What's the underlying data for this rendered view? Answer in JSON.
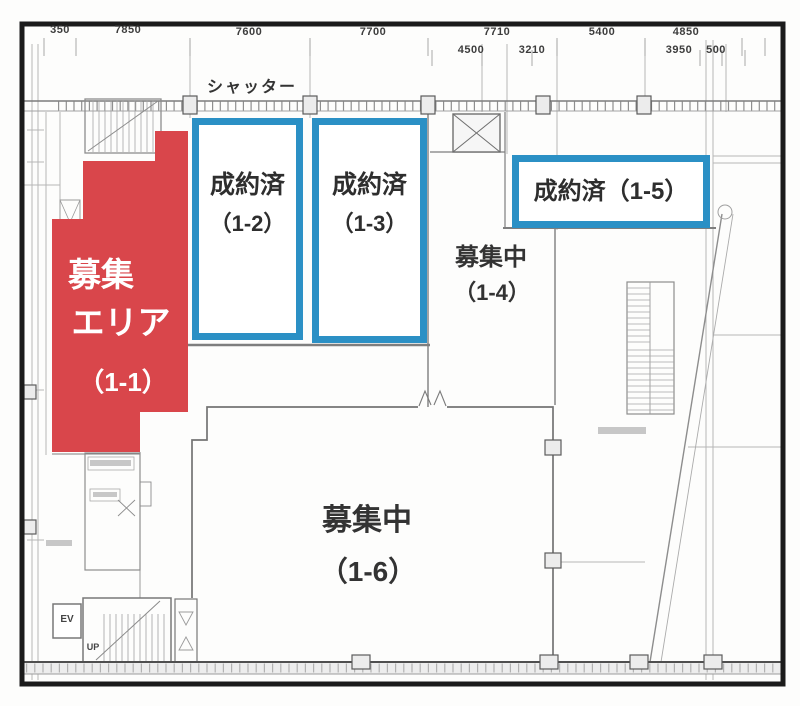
{
  "colors": {
    "red": "#d9464b",
    "blue": "#2b90c5",
    "ink": "#2e2e2e"
  },
  "dims": {
    "row1": [
      {
        "v": "350"
      },
      {
        "v": "7850"
      },
      {
        "v": "7600"
      },
      {
        "v": "7700"
      },
      {
        "v": "7710"
      },
      {
        "v": "5400"
      },
      {
        "v": "4850"
      }
    ],
    "row2": [
      {
        "v": "4500"
      },
      {
        "v": "3210"
      },
      {
        "v": "3950"
      },
      {
        "v": "500"
      }
    ]
  },
  "labels": {
    "shutter": "シャッター",
    "ev": "EV",
    "up": "UP"
  },
  "areas": {
    "a11": {
      "line1": "募集",
      "line2": "エリア",
      "unit": "（1-1）"
    },
    "a12": {
      "status": "成約済",
      "unit": "（1-2）"
    },
    "a13": {
      "status": "成約済",
      "unit": "（1-3）"
    },
    "a14": {
      "status": "募集中",
      "unit": "（1-4）"
    },
    "a15": {
      "status": "成約済（1-5）"
    },
    "a16": {
      "status": "募集中",
      "unit": "（1-6）"
    }
  }
}
